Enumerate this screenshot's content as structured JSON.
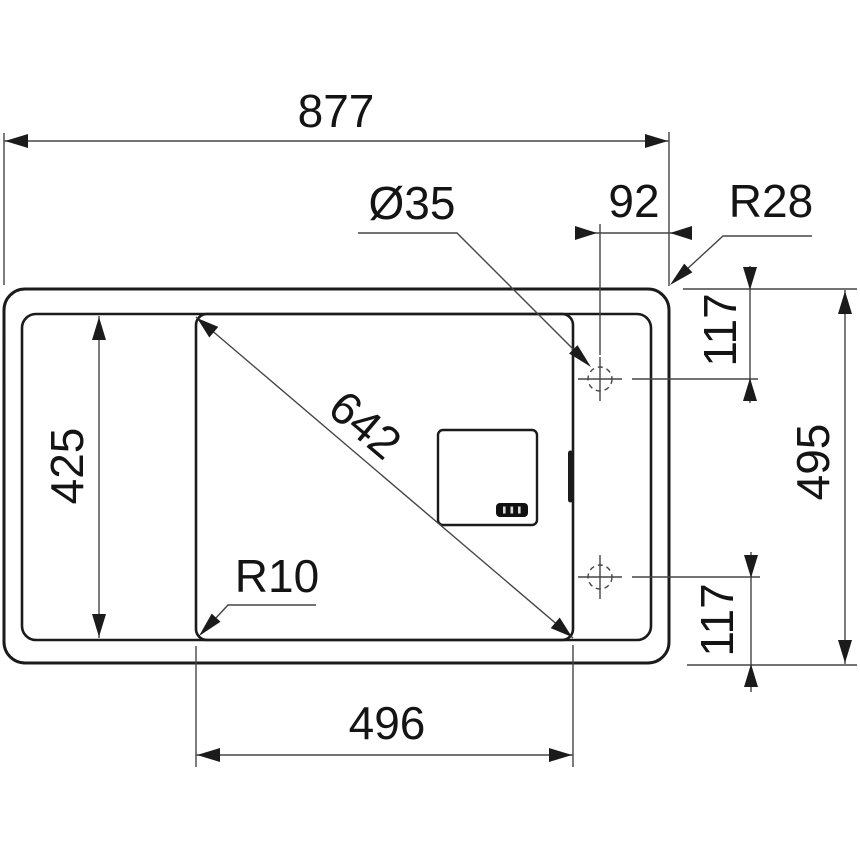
{
  "drawing": {
    "labels": {
      "overall_width": "877",
      "hole_diameter": "Ø35",
      "hole_edge_offset": "92",
      "outer_corner_radius": "R28",
      "top_hole_offset": "117",
      "overall_depth": "495",
      "bottom_hole_offset": "117",
      "inner_depth": "425",
      "bowl_diagonal": "642",
      "bowl_corner_radius": "R10",
      "bowl_width": "496"
    }
  }
}
